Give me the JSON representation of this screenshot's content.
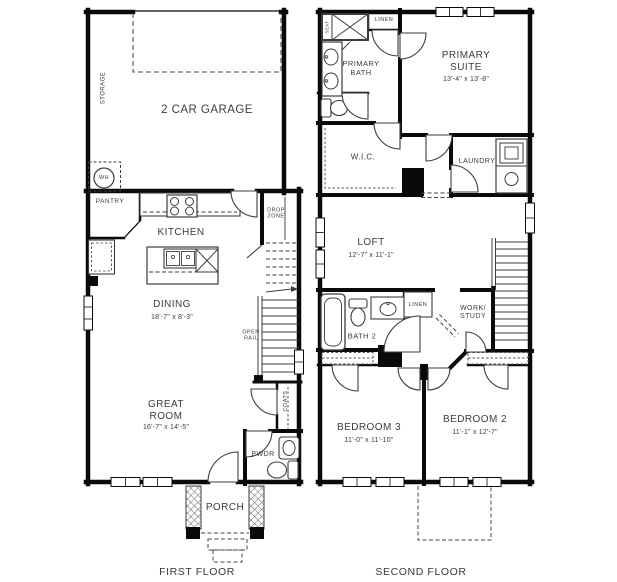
{
  "colors": {
    "wall": "#0a0a0a",
    "text": "#3c3c3c"
  },
  "ff": {
    "caption": "FIRST FLOOR",
    "storage": "STORAGE",
    "garage": "2 CAR GARAGE",
    "wh": "WH",
    "pantry": "PANTRY",
    "kitchen": "KITCHEN",
    "drop_zone": "DROP ZONE",
    "dining": "DINING",
    "dining_dims": "18'-7\" x 8'-3\"",
    "open_rail": "OPEN RAIL",
    "great_room": "GREAT ROOM",
    "great_room_dims": "16'-7\" x 14'-5\"",
    "coats": "COATS",
    "pwdr": "PWDR",
    "porch": "PORCH"
  },
  "sf": {
    "caption": "SECOND FLOOR",
    "seat": "SEAT",
    "linen": "LINEN",
    "primary_bath": "PRIMARY BATH",
    "primary_suite": "PRIMARY SUITE",
    "primary_suite_dims": "13'-4\" x 13'-8\"",
    "wic": "W.I.C.",
    "laundry": "LAUNDRY",
    "loft": "LOFT",
    "loft_dims": "12'-7\" x 11'-1\"",
    "bath2": "BATH 2",
    "linen2": "LINEN",
    "work_study": "WORK/ STUDY",
    "bedroom3": "BEDROOM 3",
    "bedroom3_dims": "11'-0\" x 11'-10\"",
    "bedroom2": "BEDROOM 2",
    "bedroom2_dims": "11'-1\" x 12'-7\""
  }
}
